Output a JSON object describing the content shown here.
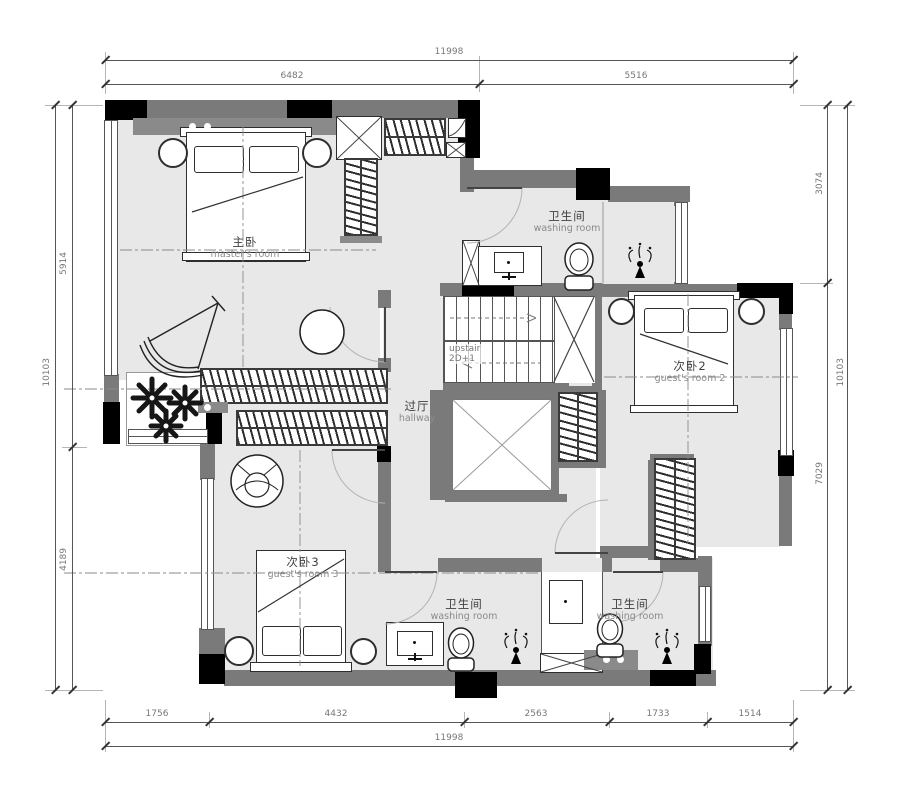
{
  "colors": {
    "wall": "#7a7a7a",
    "column": "#000000",
    "floor": "#e8e8e8",
    "line": "#444444",
    "dim_text": "#777777"
  },
  "rooms": {
    "master": {
      "zh": "主卧",
      "en": "master's room"
    },
    "wash_top": {
      "zh": "卫生间",
      "en": "washing room"
    },
    "guest2": {
      "zh": "次卧2",
      "en": "guest's room 2"
    },
    "hallway": {
      "zh": "过厅",
      "en": "hallway"
    },
    "guest3": {
      "zh": "次卧3",
      "en": "guest's room 3"
    },
    "wash_bl": {
      "zh": "卫生间",
      "en": "washing room"
    },
    "wash_br": {
      "zh": "卫生间",
      "en": "washing room"
    },
    "stairs": {
      "line1": "upstair",
      "line2": "2D+1"
    }
  },
  "dims": {
    "top_total": "11998",
    "top_left": "6482",
    "top_right": "5516",
    "left_total": "10103",
    "left_upper": "5914",
    "left_lower": "4189",
    "right_total": "10103",
    "right_upper": "3074",
    "right_lower": "7029",
    "bottom_total": "11998",
    "bottom_1": "1756",
    "bottom_2": "4432",
    "bottom_3": "2563",
    "bottom_4": "1733",
    "bottom_5": "1514"
  }
}
